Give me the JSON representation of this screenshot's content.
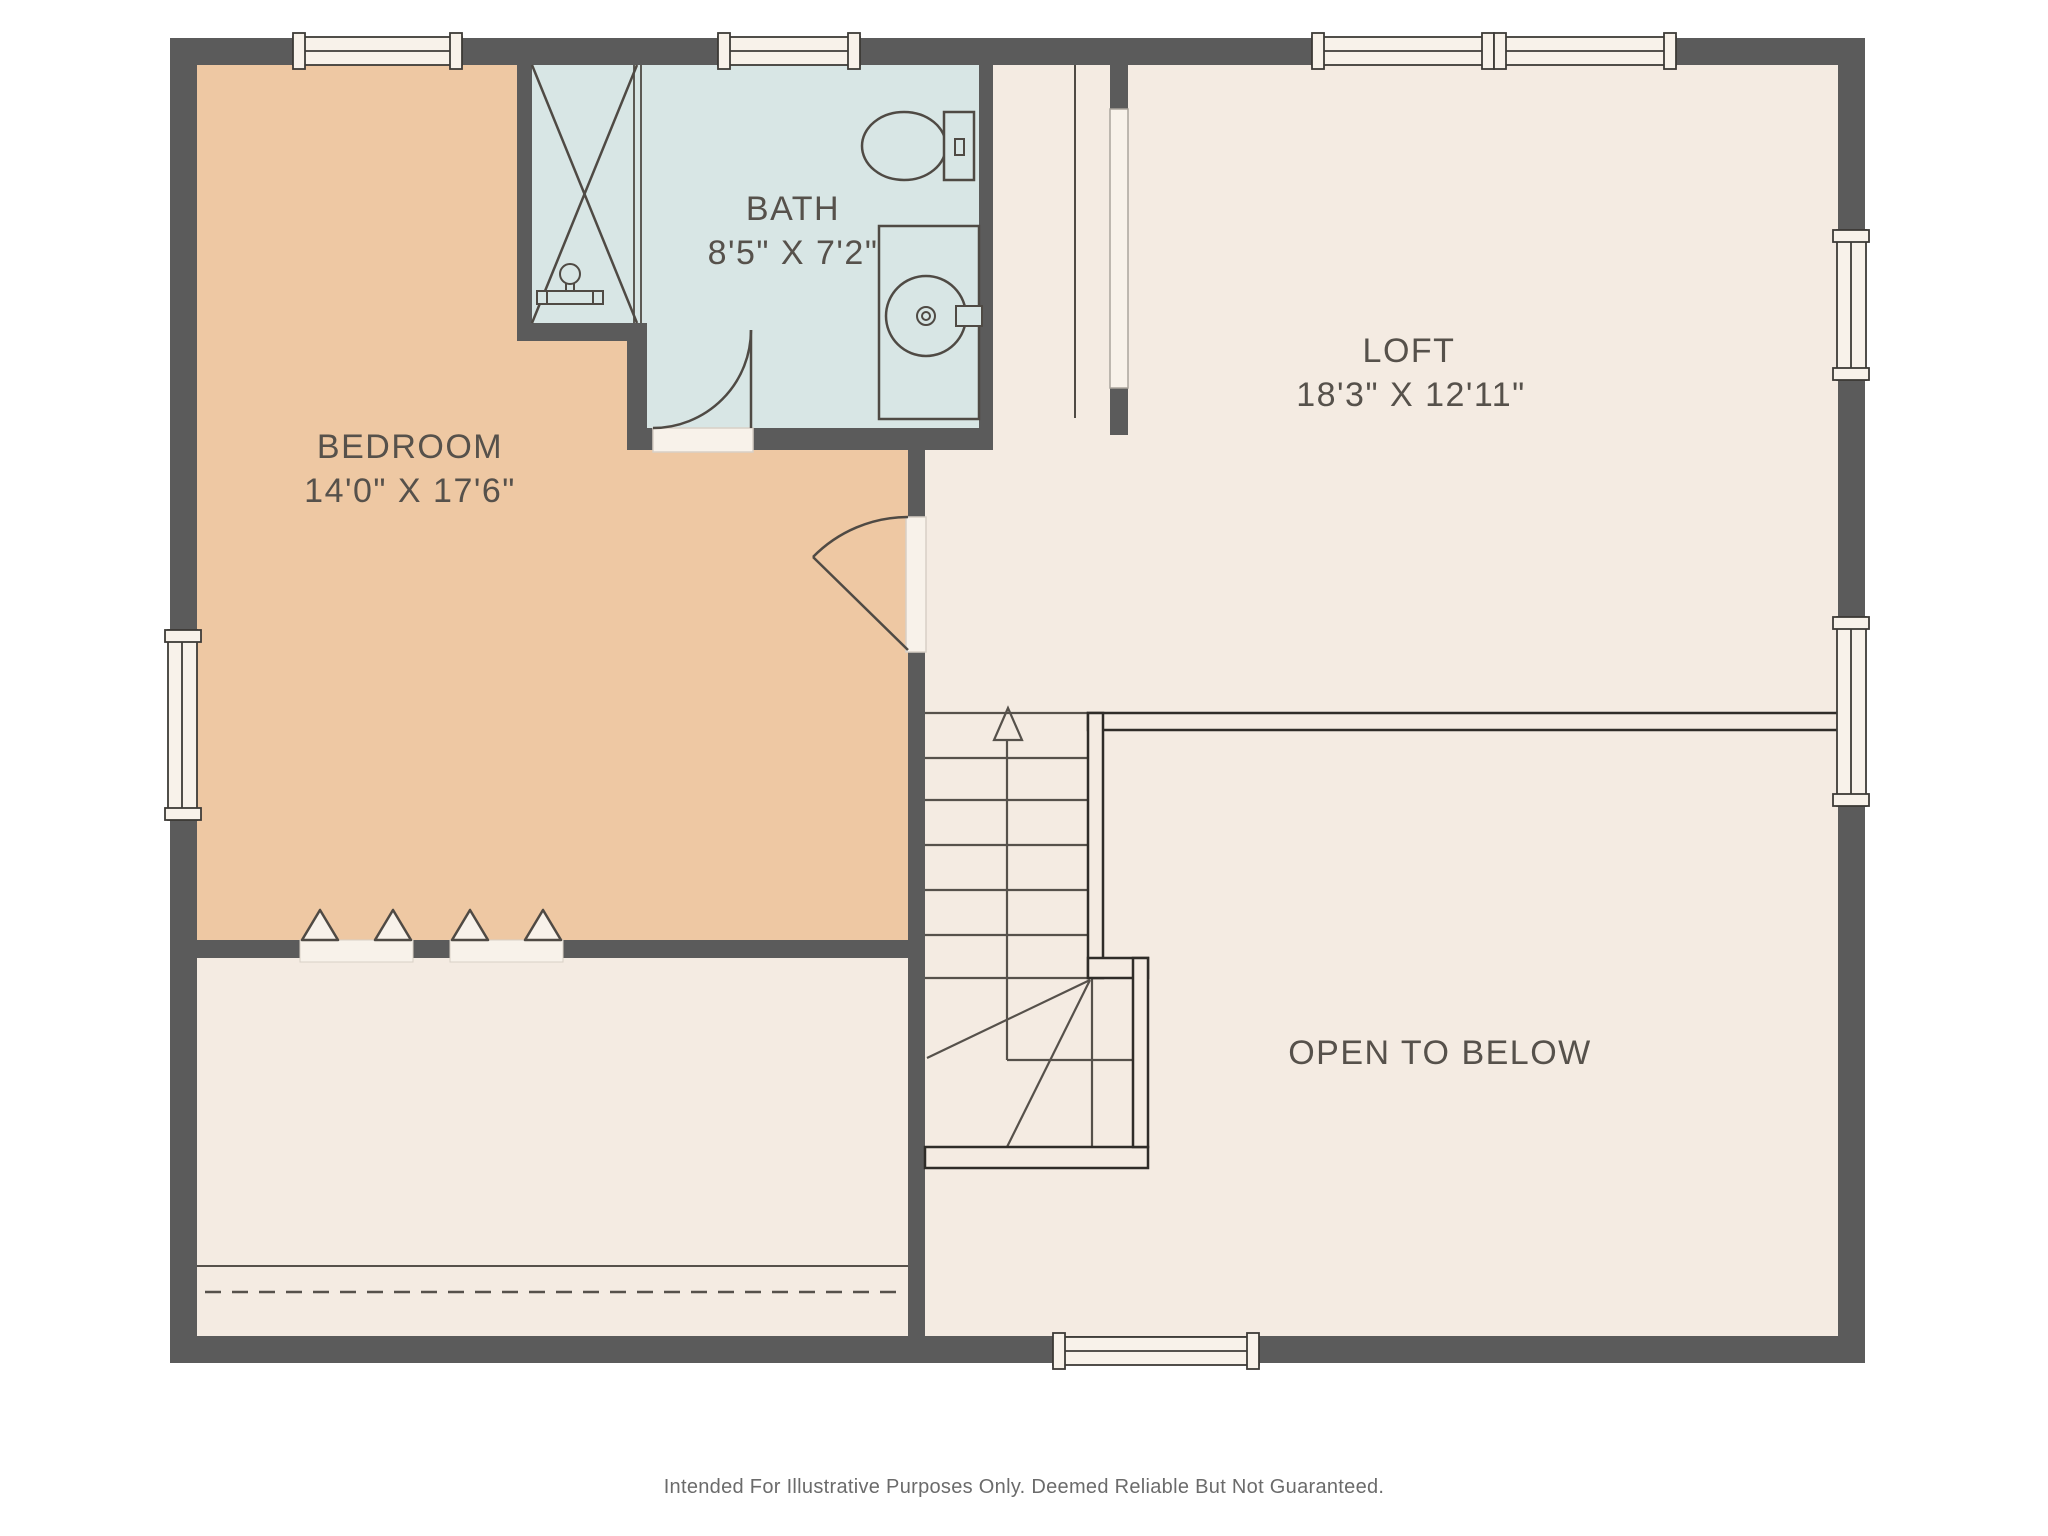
{
  "page": {
    "background": "#ffffff",
    "disclaimer": "Intended For Illustrative Purposes Only. Deemed Reliable But Not Guaranteed."
  },
  "floor_plan": {
    "rooms": {
      "bedroom": {
        "label": "BEDROOM",
        "dimensions": "14'0\" X 17'6\""
      },
      "bath": {
        "label": "BATH",
        "dimensions": "8'5\" X 7'2\""
      },
      "loft": {
        "label": "LOFT",
        "dimensions": "18'3\" X 12'11\""
      },
      "open_to_below": {
        "label": "OPEN TO BELOW"
      }
    },
    "stairs": {
      "direction": "up",
      "upper_run_treads": 7,
      "winder_turn": true
    },
    "fixtures": [
      "shower",
      "shower-valve",
      "toilet",
      "vanity-round-sink"
    ],
    "doors": [
      "bath-swing-door",
      "bedroom-swing-door",
      "closet-bifold-pair-left",
      "closet-bifold-pair-right",
      "closet-cased-opening"
    ],
    "windows": {
      "top_wall": 3,
      "right_wall": 2,
      "left_wall": 1,
      "bottom_wall": 1
    },
    "colors": {
      "wall": "#5b5b5b",
      "floor": "#f4ebe2",
      "bedroom_floor": "#eec8a3",
      "bath_floor": "#d8e6e5",
      "window_fill": "#f8f2ea",
      "line": "#4f4a44",
      "stair_line": "#56514b",
      "railing_line": "#2f2c28",
      "text": "#56514b",
      "disclaimer_text": "#6b6b6b"
    }
  }
}
